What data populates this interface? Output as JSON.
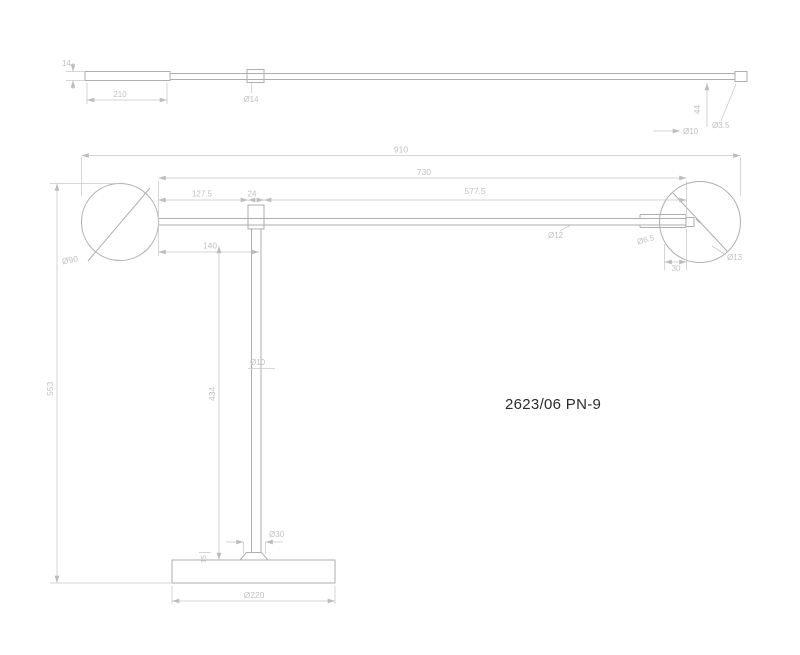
{
  "title_label": "2623/06 PN-9",
  "colors": {
    "background": "#ffffff",
    "object_line": "#aeaeae",
    "dimension_line": "#c9c9c9",
    "dimension_text": "#c1c1c1",
    "label_text": "#2a2a2a"
  },
  "top_view": {
    "dims": {
      "end_height": "14",
      "grip_length": "210",
      "collar_diameter": "Ø14",
      "end_drop": "44",
      "hole_diameter": "Ø3.5",
      "tube_diameter": "Ø10"
    }
  },
  "front_view": {
    "dims": {
      "overall_width": "910",
      "arm_span": "730",
      "shade_to_collar": "127.5",
      "collar_width": "24",
      "collar_to_tip": "577.5",
      "shade_diameter": "Ø90",
      "arm_diameter": "Ø12",
      "head_offset": "140",
      "socket_diameter": "Ø6.5",
      "socket_length": "30",
      "head_hole_diameter": "Ø13",
      "post_diameter": "Ø10",
      "post_height": "434",
      "overall_height": "553",
      "cap_height": "15",
      "cap_diameter": "Ø30",
      "base_diameter": "Ø220"
    }
  }
}
